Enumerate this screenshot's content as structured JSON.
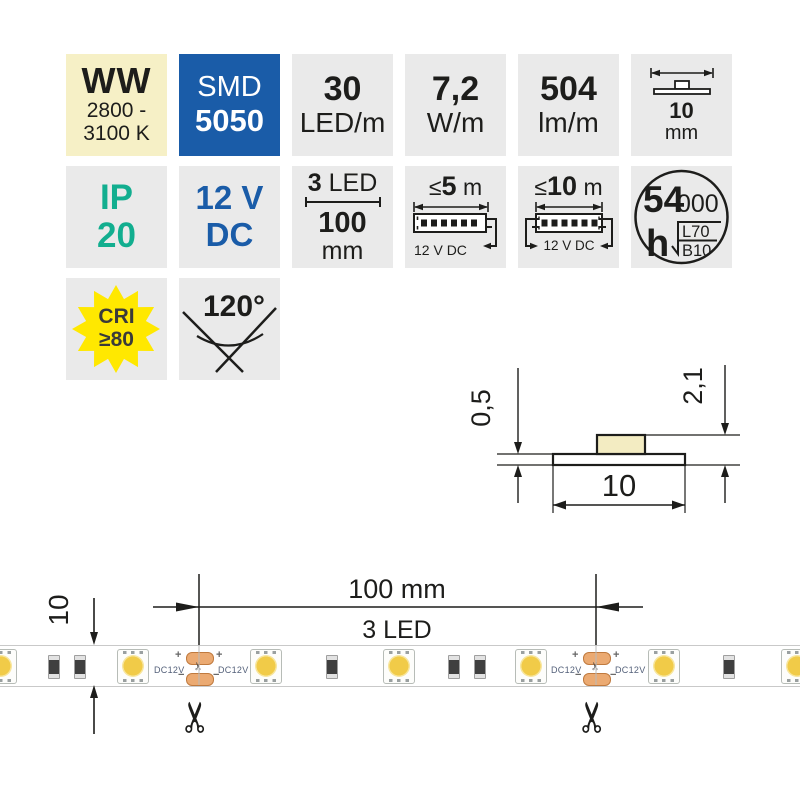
{
  "tiles": {
    "ww": {
      "title": "WW",
      "temp1": "2800 -",
      "temp2": "3100 K"
    },
    "smd": {
      "top": "SMD",
      "bottom": "5050"
    },
    "density": {
      "value": "30",
      "unit": "LED/m"
    },
    "power": {
      "value": "7,2",
      "unit": "W/m"
    },
    "flux": {
      "value": "504",
      "unit": "lm/m"
    },
    "width": {
      "value": "10",
      "unit": "mm"
    },
    "ip": {
      "top": "IP",
      "bottom": "20"
    },
    "voltage": {
      "top": "12 V",
      "bottom": "DC"
    },
    "cut": {
      "leds_value": "3",
      "leds_unit": "LED",
      "len_value": "100",
      "len_unit": "mm"
    },
    "max5": {
      "lte": "≤",
      "value": "5",
      "unit": "m",
      "supply": "12 V DC"
    },
    "max10": {
      "lte": "≤",
      "value": "10",
      "unit": "m",
      "supply": "12 V DC"
    },
    "lifetime": {
      "value": "54",
      "zeros": "000",
      "unit": "h",
      "l70": "L70",
      "b10": "B10"
    },
    "cri": {
      "top": "CRI",
      "bottom": "≥80"
    },
    "beam": {
      "angle": "120°"
    }
  },
  "cross_section": {
    "thickness": "0,5",
    "total_height": "2,1",
    "width": "10"
  },
  "strip": {
    "height_dim": "10",
    "pitch_label": "100 mm",
    "pitch_leds": "3 LED",
    "dc": "DC12V",
    "plus": "+",
    "minus": "−",
    "scissors": "✂"
  },
  "colors": {
    "tile_gray": "#EAEAEA",
    "warm_white_cream": "#F6F0C6",
    "brand_blue": "#1A5CA8",
    "ip_teal": "#12AE8F",
    "cri_yellow": "#FFE800",
    "led_yellow": "#F1CB48",
    "pad_copper": "#EBAA72"
  }
}
